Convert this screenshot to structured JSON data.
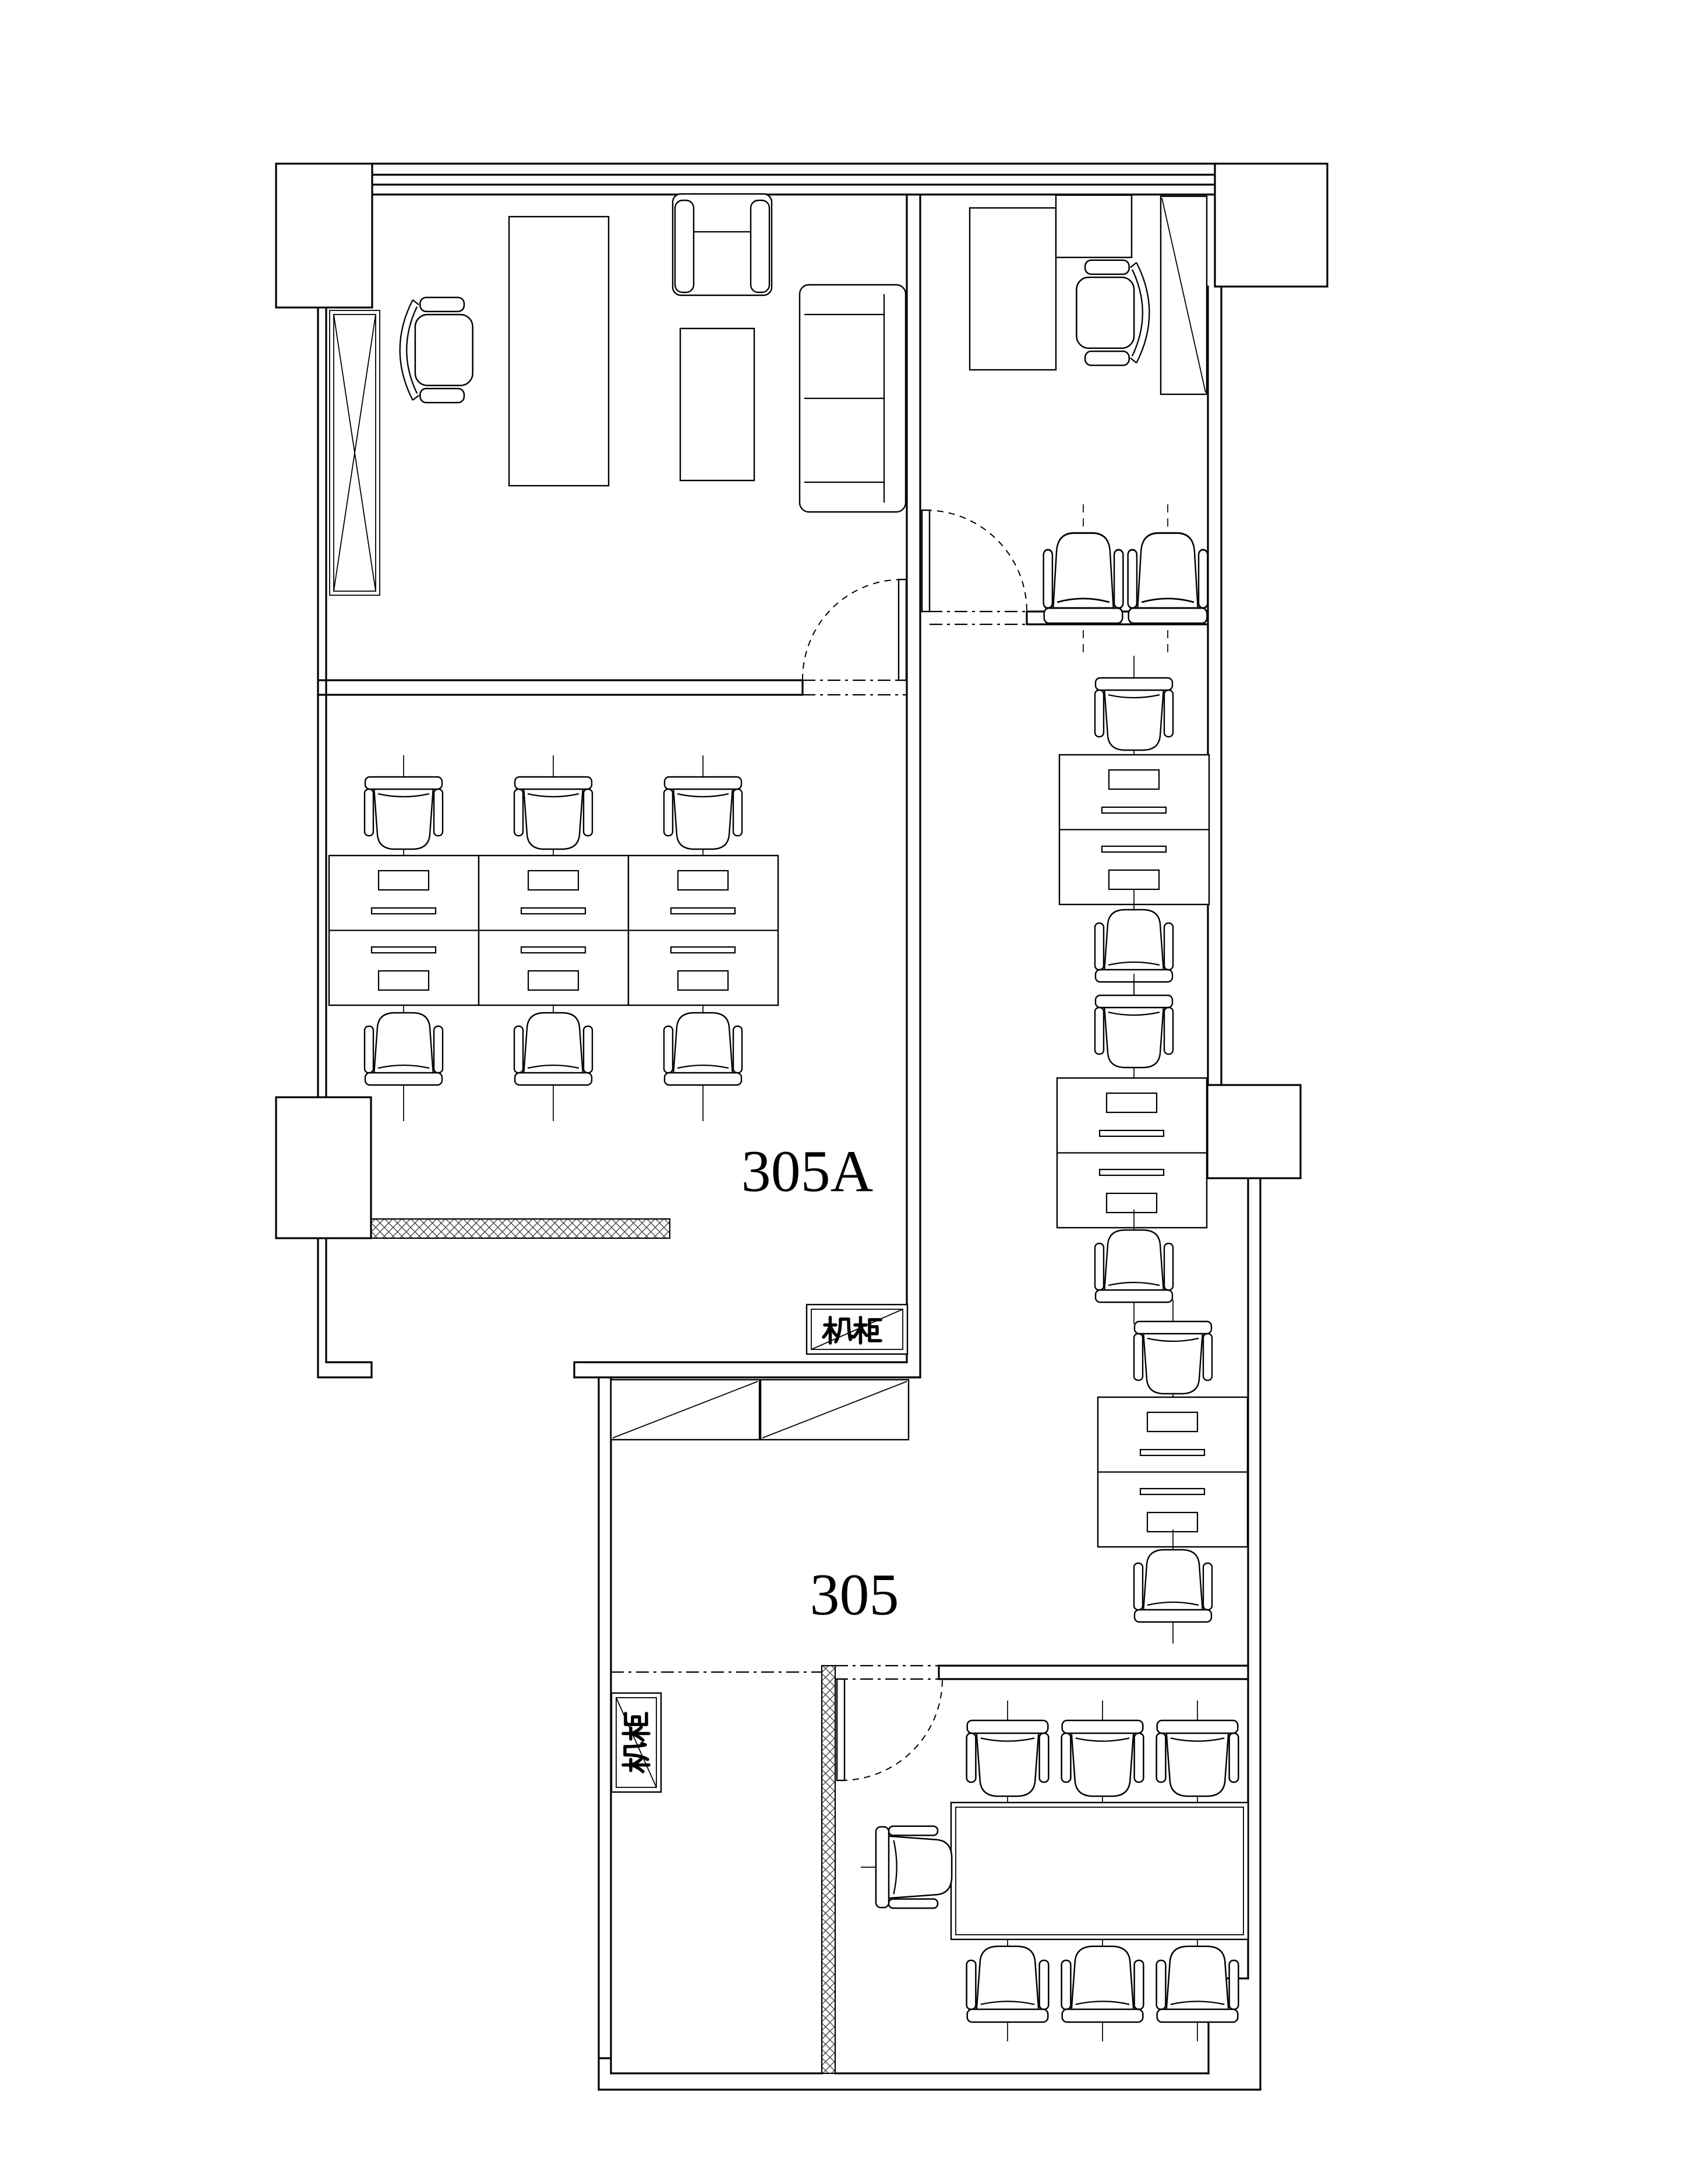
{
  "page": {
    "background_color": "#ffffff",
    "line_color": "#000000",
    "hatch_color": "#444444",
    "type": "architectural floor plan"
  },
  "labels": {
    "room_305a": "305A",
    "room_305": "305",
    "rack_horizontal": "机柜",
    "rack_vertical": "机柜"
  },
  "plan_inventory": {
    "rooms": [
      {
        "name": "private-office-west",
        "furniture": [
          "executive-desk",
          "executive-chair",
          "armchair",
          "coffee-table",
          "two-seat-sofa"
        ]
      },
      {
        "name": "private-office-east",
        "furniture": [
          "executive-desk",
          "desk-return",
          "executive-chair",
          "tall-cabinet",
          "waiting-chair",
          "waiting-chair"
        ]
      },
      {
        "name": "open-office-305A",
        "workstations": 6,
        "server_racks": 1
      },
      {
        "name": "open-area-305",
        "workstations": 6,
        "server_racks": 1,
        "storage_cabinets": 2
      },
      {
        "name": "conference-room",
        "tables": 1,
        "chairs": 7
      }
    ],
    "doors_with_swing_arcs": 3,
    "x_braced_window_panels": 1,
    "hatched_wall_segments": 2,
    "structural_piers": 4
  }
}
